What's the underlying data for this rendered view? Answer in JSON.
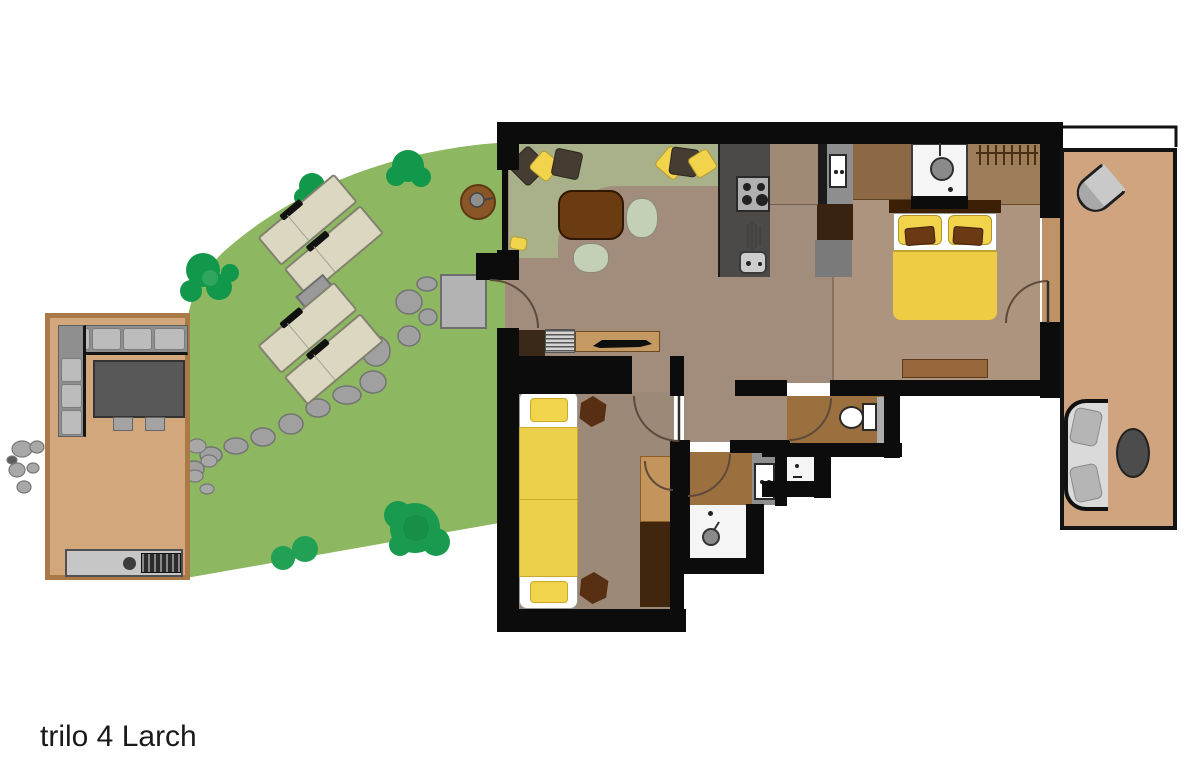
{
  "title": {
    "label": "trilo 4 Larch"
  },
  "palette": {
    "wall": "#0c0c0c",
    "garden": "#8db761",
    "tree": "#12984a",
    "tree_light": "#2fa55e",
    "deck_left": "#d2a77b",
    "deck_left_border": "#a97a48",
    "deck_right": "#cfa47e",
    "floor_living": "#a28c7c",
    "floor_bedroom": "#ad947f",
    "floor_bunk": "#9c8978",
    "rug": "#a8b189",
    "bath_floor": "#9c6f3f",
    "closet_tan": "#c3955c",
    "closet_dark": "#40260d",
    "bed_yellow": "#f2d44c",
    "duvet_yellow": "#eecd45",
    "cushion_brown": "#6b3a14",
    "kitchen_counter": "#4c4a48",
    "fixture_white": "#f5f5f5",
    "stone_gray": "#a0a0a0",
    "sofa_gray": "#bcbcbc",
    "table_dark": "#585858",
    "lounger_cream": "#dcd7c1",
    "coffee_table": "#6b3b12",
    "pillow_dark": "#453c32",
    "headboard": "#3c2005",
    "wardrobe": "#9c7c59",
    "cabinet_brown": "#8d6844",
    "mat_gray": "#b3b3b3"
  }
}
